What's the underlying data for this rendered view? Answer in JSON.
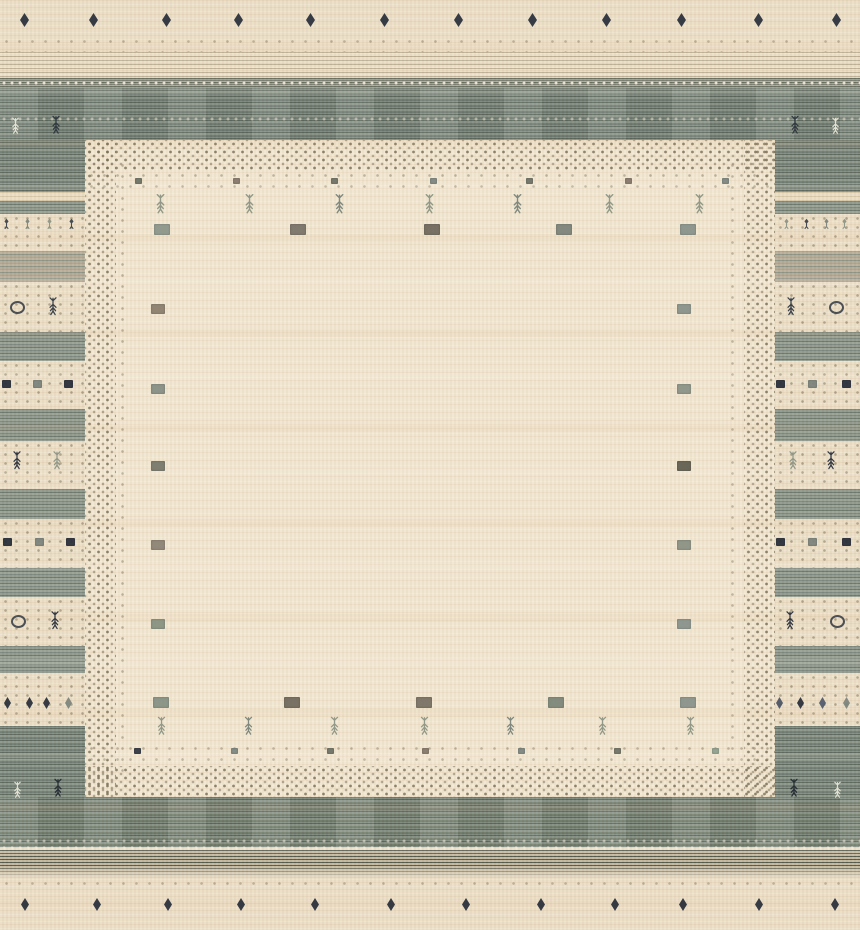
{
  "subject": "hand-knotted gabbeh-style wool rug, cream field with gray-green frame and tribal motifs",
  "palette": {
    "cream": "#ebdfc8",
    "cream-field": "#f1e6d0",
    "gray-band": "#79837a",
    "gray-band-dark": "#5f6a5f",
    "gray-band-light": "#8d978b",
    "tan-band": "#a8a494",
    "dot": "#7d7158",
    "navy": "#262c38",
    "slate": "#7b837c",
    "sage": "#8b9383",
    "olive": "#6f7265",
    "brown": "#8a7c6a",
    "white-motif": "#edeadb"
  },
  "frame": {
    "top_gray_band": {
      "y": 88,
      "h": 52
    },
    "bottom_gray_band": {
      "y": 797,
      "h": 50
    },
    "side_width": 85
  },
  "border_bands": [
    {
      "y": 140,
      "h": 52,
      "k": "grayext"
    },
    {
      "y": 192,
      "h": 9,
      "k": "tan"
    },
    {
      "y": 201,
      "h": 13,
      "k": "gray"
    },
    {
      "y": 214,
      "h": 37,
      "k": "dots"
    },
    {
      "y": 251,
      "h": 31,
      "k": "tanband"
    },
    {
      "y": 282,
      "h": 50,
      "k": "dots"
    },
    {
      "y": 332,
      "h": 29,
      "k": "gray"
    },
    {
      "y": 361,
      "h": 48,
      "k": "dots"
    },
    {
      "y": 409,
      "h": 32,
      "k": "gray"
    },
    {
      "y": 441,
      "h": 48,
      "k": "dots"
    },
    {
      "y": 489,
      "h": 30,
      "k": "gray"
    },
    {
      "y": 519,
      "h": 49,
      "k": "dots"
    },
    {
      "y": 568,
      "h": 29,
      "k": "gray"
    },
    {
      "y": 597,
      "h": 49,
      "k": "dots"
    },
    {
      "y": 646,
      "h": 27,
      "k": "gray"
    },
    {
      "y": 673,
      "h": 53,
      "k": "dots"
    },
    {
      "y": 726,
      "h": 71,
      "k": "grayext"
    }
  ],
  "motifs": [
    {
      "t": "d",
      "x": 20,
      "y": 13,
      "w": 9,
      "h": 14,
      "c": "#262c38"
    },
    {
      "t": "d",
      "x": 89,
      "y": 13,
      "w": 9,
      "h": 14,
      "c": "#262c38"
    },
    {
      "t": "d",
      "x": 162,
      "y": 13,
      "w": 9,
      "h": 14,
      "c": "#262c38"
    },
    {
      "t": "d",
      "x": 234,
      "y": 13,
      "w": 9,
      "h": 14,
      "c": "#262c38"
    },
    {
      "t": "d",
      "x": 306,
      "y": 13,
      "w": 9,
      "h": 14,
      "c": "#262c38"
    },
    {
      "t": "d",
      "x": 380,
      "y": 13,
      "w": 9,
      "h": 14,
      "c": "#262c38"
    },
    {
      "t": "d",
      "x": 454,
      "y": 13,
      "w": 9,
      "h": 14,
      "c": "#262c38"
    },
    {
      "t": "d",
      "x": 528,
      "y": 13,
      "w": 9,
      "h": 14,
      "c": "#262c38"
    },
    {
      "t": "d",
      "x": 602,
      "y": 13,
      "w": 9,
      "h": 14,
      "c": "#262c38"
    },
    {
      "t": "d",
      "x": 677,
      "y": 13,
      "w": 9,
      "h": 14,
      "c": "#262c38"
    },
    {
      "t": "d",
      "x": 754,
      "y": 13,
      "w": 9,
      "h": 14,
      "c": "#262c38"
    },
    {
      "t": "d",
      "x": 832,
      "y": 13,
      "w": 9,
      "h": 14,
      "c": "#262c38"
    },
    {
      "t": "t",
      "x": 10,
      "y": 117,
      "w": 11,
      "h": 17,
      "c": "#edeadb"
    },
    {
      "t": "t",
      "x": 50,
      "y": 115,
      "w": 12,
      "h": 19,
      "c": "#2c333d"
    },
    {
      "t": "t",
      "x": 789,
      "y": 115,
      "w": 12,
      "h": 19,
      "c": "#2c333d"
    },
    {
      "t": "t",
      "x": 830,
      "y": 117,
      "w": 11,
      "h": 17,
      "c": "#edeadb"
    },
    {
      "t": "s",
      "x": 135,
      "y": 178,
      "w": 7,
      "h": 6,
      "c": "#6d7164"
    },
    {
      "t": "s",
      "x": 233,
      "y": 178,
      "w": 7,
      "h": 6,
      "c": "#84776a"
    },
    {
      "t": "s",
      "x": 331,
      "y": 178,
      "w": 7,
      "h": 6,
      "c": "#6d7164"
    },
    {
      "t": "s",
      "x": 430,
      "y": 178,
      "w": 7,
      "h": 6,
      "c": "#7c8680"
    },
    {
      "t": "s",
      "x": 526,
      "y": 178,
      "w": 7,
      "h": 6,
      "c": "#6d7164"
    },
    {
      "t": "s",
      "x": 625,
      "y": 178,
      "w": 7,
      "h": 6,
      "c": "#84776a"
    },
    {
      "t": "s",
      "x": 722,
      "y": 178,
      "w": 7,
      "h": 6,
      "c": "#7c8680"
    },
    {
      "t": "t",
      "x": 154,
      "y": 193,
      "w": 13,
      "h": 21,
      "c": "#8b9383"
    },
    {
      "t": "t",
      "x": 243,
      "y": 193,
      "w": 13,
      "h": 21,
      "c": "#8b9383"
    },
    {
      "t": "t",
      "x": 333,
      "y": 193,
      "w": 13,
      "h": 21,
      "c": "#77827a"
    },
    {
      "t": "t",
      "x": 423,
      "y": 193,
      "w": 13,
      "h": 21,
      "c": "#8b9383"
    },
    {
      "t": "t",
      "x": 511,
      "y": 193,
      "w": 13,
      "h": 21,
      "c": "#77827a"
    },
    {
      "t": "t",
      "x": 603,
      "y": 193,
      "w": 13,
      "h": 21,
      "c": "#8b9383"
    },
    {
      "t": "t",
      "x": 693,
      "y": 193,
      "w": 13,
      "h": 21,
      "c": "#8b9383"
    },
    {
      "t": "s",
      "x": 154,
      "y": 224,
      "w": 16,
      "h": 11,
      "c": "#8b9489"
    },
    {
      "t": "s",
      "x": 290,
      "y": 224,
      "w": 16,
      "h": 11,
      "c": "#787166"
    },
    {
      "t": "s",
      "x": 424,
      "y": 224,
      "w": 16,
      "h": 11,
      "c": "#6e675b"
    },
    {
      "t": "s",
      "x": 556,
      "y": 224,
      "w": 16,
      "h": 11,
      "c": "#7b8279"
    },
    {
      "t": "s",
      "x": 680,
      "y": 224,
      "w": 16,
      "h": 11,
      "c": "#87918a"
    },
    {
      "t": "s",
      "x": 151,
      "y": 304,
      "w": 14,
      "h": 10,
      "c": "#8a7d6c"
    },
    {
      "t": "s",
      "x": 151,
      "y": 384,
      "w": 14,
      "h": 10,
      "c": "#858d83"
    },
    {
      "t": "s",
      "x": 151,
      "y": 461,
      "w": 14,
      "h": 10,
      "c": "#75766a"
    },
    {
      "t": "s",
      "x": 151,
      "y": 540,
      "w": 14,
      "h": 10,
      "c": "#8b8274"
    },
    {
      "t": "s",
      "x": 151,
      "y": 619,
      "w": 14,
      "h": 10,
      "c": "#86907f"
    },
    {
      "t": "s",
      "x": 677,
      "y": 304,
      "w": 14,
      "h": 10,
      "c": "#87918a"
    },
    {
      "t": "s",
      "x": 677,
      "y": 384,
      "w": 14,
      "h": 10,
      "c": "#8a9286"
    },
    {
      "t": "s",
      "x": 677,
      "y": 461,
      "w": 14,
      "h": 10,
      "c": "#5f5c4e"
    },
    {
      "t": "s",
      "x": 677,
      "y": 540,
      "w": 14,
      "h": 10,
      "c": "#899083"
    },
    {
      "t": "s",
      "x": 677,
      "y": 619,
      "w": 14,
      "h": 10,
      "c": "#87918a"
    },
    {
      "t": "s",
      "x": 153,
      "y": 697,
      "w": 16,
      "h": 11,
      "c": "#849083"
    },
    {
      "t": "s",
      "x": 284,
      "y": 697,
      "w": 16,
      "h": 11,
      "c": "#6e675b"
    },
    {
      "t": "s",
      "x": 416,
      "y": 697,
      "w": 16,
      "h": 11,
      "c": "#776f62"
    },
    {
      "t": "s",
      "x": 548,
      "y": 697,
      "w": 16,
      "h": 11,
      "c": "#7b8478"
    },
    {
      "t": "s",
      "x": 680,
      "y": 697,
      "w": 16,
      "h": 11,
      "c": "#87918a"
    },
    {
      "t": "t",
      "x": 155,
      "y": 716,
      "w": 13,
      "h": 19,
      "c": "#8b9383"
    },
    {
      "t": "t",
      "x": 242,
      "y": 716,
      "w": 13,
      "h": 19,
      "c": "#77827a"
    },
    {
      "t": "t",
      "x": 328,
      "y": 716,
      "w": 13,
      "h": 19,
      "c": "#8b9383"
    },
    {
      "t": "t",
      "x": 418,
      "y": 716,
      "w": 13,
      "h": 19,
      "c": "#8b9383"
    },
    {
      "t": "t",
      "x": 504,
      "y": 716,
      "w": 13,
      "h": 19,
      "c": "#77827a"
    },
    {
      "t": "t",
      "x": 596,
      "y": 716,
      "w": 13,
      "h": 19,
      "c": "#8b9383"
    },
    {
      "t": "t",
      "x": 684,
      "y": 716,
      "w": 13,
      "h": 19,
      "c": "#8b9383"
    },
    {
      "t": "s",
      "x": 134,
      "y": 748,
      "w": 7,
      "h": 6,
      "c": "#2e3440"
    },
    {
      "t": "s",
      "x": 231,
      "y": 748,
      "w": 7,
      "h": 6,
      "c": "#7c8680"
    },
    {
      "t": "s",
      "x": 327,
      "y": 748,
      "w": 7,
      "h": 6,
      "c": "#6d7164"
    },
    {
      "t": "s",
      "x": 422,
      "y": 748,
      "w": 7,
      "h": 6,
      "c": "#84776a"
    },
    {
      "t": "s",
      "x": 518,
      "y": 748,
      "w": 7,
      "h": 6,
      "c": "#7c8680"
    },
    {
      "t": "s",
      "x": 614,
      "y": 748,
      "w": 7,
      "h": 6,
      "c": "#6d7164"
    },
    {
      "t": "s",
      "x": 712,
      "y": 748,
      "w": 7,
      "h": 6,
      "c": "#8fa08f"
    },
    {
      "t": "y",
      "x": 3,
      "y": 218,
      "w": 7,
      "h": 12,
      "c": "#3a4048"
    },
    {
      "t": "y",
      "x": 24,
      "y": 218,
      "w": 7,
      "h": 12,
      "c": "#7b837c"
    },
    {
      "t": "y",
      "x": 46,
      "y": 218,
      "w": 7,
      "h": 12,
      "c": "#8b9383"
    },
    {
      "t": "y",
      "x": 68,
      "y": 218,
      "w": 7,
      "h": 12,
      "c": "#3a4048"
    },
    {
      "t": "c",
      "x": 10,
      "y": 301,
      "w": 11,
      "h": 9,
      "c": "#3f444b"
    },
    {
      "t": "t",
      "x": 47,
      "y": 296,
      "w": 12,
      "h": 20,
      "c": "#2e3640"
    },
    {
      "t": "s",
      "x": 2,
      "y": 380,
      "w": 9,
      "h": 8,
      "c": "#262c38"
    },
    {
      "t": "s",
      "x": 33,
      "y": 380,
      "w": 9,
      "h": 8,
      "c": "#7b837c"
    },
    {
      "t": "s",
      "x": 64,
      "y": 380,
      "w": 9,
      "h": 8,
      "c": "#262c38"
    },
    {
      "t": "t",
      "x": 11,
      "y": 450,
      "w": 12,
      "h": 20,
      "c": "#262c38"
    },
    {
      "t": "t",
      "x": 51,
      "y": 450,
      "w": 12,
      "h": 20,
      "c": "#8b9383"
    },
    {
      "t": "s",
      "x": 3,
      "y": 538,
      "w": 9,
      "h": 8,
      "c": "#262c38"
    },
    {
      "t": "s",
      "x": 35,
      "y": 538,
      "w": 9,
      "h": 8,
      "c": "#7b837c"
    },
    {
      "t": "s",
      "x": 66,
      "y": 538,
      "w": 9,
      "h": 8,
      "c": "#262c38"
    },
    {
      "t": "c",
      "x": 11,
      "y": 615,
      "w": 11,
      "h": 9,
      "c": "#3f444b"
    },
    {
      "t": "t",
      "x": 49,
      "y": 610,
      "w": 12,
      "h": 20,
      "c": "#262c38"
    },
    {
      "t": "d",
      "x": 4,
      "y": 697,
      "w": 7,
      "h": 12,
      "c": "#262c38"
    },
    {
      "t": "d",
      "x": 26,
      "y": 697,
      "w": 7,
      "h": 12,
      "c": "#262c38"
    },
    {
      "t": "d",
      "x": 43,
      "y": 697,
      "w": 7,
      "h": 12,
      "c": "#262c38"
    },
    {
      "t": "d",
      "x": 65,
      "y": 697,
      "w": 7,
      "h": 12,
      "c": "#7b837c"
    },
    {
      "t": "t",
      "x": 12,
      "y": 781,
      "w": 11,
      "h": 17,
      "c": "#e8e8da"
    },
    {
      "t": "t",
      "x": 52,
      "y": 778,
      "w": 12,
      "h": 19,
      "c": "#222831"
    },
    {
      "t": "y",
      "x": 783,
      "y": 218,
      "w": 7,
      "h": 12,
      "c": "#8b9383"
    },
    {
      "t": "y",
      "x": 803,
      "y": 218,
      "w": 7,
      "h": 12,
      "c": "#3a4048"
    },
    {
      "t": "y",
      "x": 823,
      "y": 218,
      "w": 7,
      "h": 12,
      "c": "#7b837c"
    },
    {
      "t": "y",
      "x": 841,
      "y": 218,
      "w": 7,
      "h": 12,
      "c": "#8b9383"
    },
    {
      "t": "t",
      "x": 785,
      "y": 296,
      "w": 12,
      "h": 20,
      "c": "#2e3640"
    },
    {
      "t": "c",
      "x": 829,
      "y": 301,
      "w": 11,
      "h": 9,
      "c": "#3f444b"
    },
    {
      "t": "s",
      "x": 776,
      "y": 380,
      "w": 9,
      "h": 8,
      "c": "#262c38"
    },
    {
      "t": "s",
      "x": 808,
      "y": 380,
      "w": 9,
      "h": 8,
      "c": "#7b837c"
    },
    {
      "t": "s",
      "x": 842,
      "y": 380,
      "w": 9,
      "h": 8,
      "c": "#262c38"
    },
    {
      "t": "t",
      "x": 787,
      "y": 450,
      "w": 12,
      "h": 20,
      "c": "#8b9383"
    },
    {
      "t": "t",
      "x": 825,
      "y": 450,
      "w": 12,
      "h": 20,
      "c": "#262c38"
    },
    {
      "t": "s",
      "x": 776,
      "y": 538,
      "w": 9,
      "h": 8,
      "c": "#262c38"
    },
    {
      "t": "s",
      "x": 808,
      "y": 538,
      "w": 9,
      "h": 8,
      "c": "#7b837c"
    },
    {
      "t": "s",
      "x": 842,
      "y": 538,
      "w": 9,
      "h": 8,
      "c": "#262c38"
    },
    {
      "t": "t",
      "x": 784,
      "y": 610,
      "w": 12,
      "h": 20,
      "c": "#262c38"
    },
    {
      "t": "c",
      "x": 830,
      "y": 615,
      "w": 11,
      "h": 9,
      "c": "#3f444b"
    },
    {
      "t": "d",
      "x": 776,
      "y": 697,
      "w": 7,
      "h": 12,
      "c": "#4a5363"
    },
    {
      "t": "d",
      "x": 797,
      "y": 697,
      "w": 7,
      "h": 12,
      "c": "#262c38"
    },
    {
      "t": "d",
      "x": 819,
      "y": 697,
      "w": 7,
      "h": 12,
      "c": "#4f586a"
    },
    {
      "t": "d",
      "x": 843,
      "y": 697,
      "w": 7,
      "h": 12,
      "c": "#7b837c"
    },
    {
      "t": "t",
      "x": 788,
      "y": 778,
      "w": 12,
      "h": 19,
      "c": "#222831"
    },
    {
      "t": "t",
      "x": 832,
      "y": 781,
      "w": 11,
      "h": 17,
      "c": "#e8e8da"
    },
    {
      "t": "d",
      "x": 21,
      "y": 898,
      "w": 8,
      "h": 13,
      "c": "#262c38"
    },
    {
      "t": "d",
      "x": 93,
      "y": 898,
      "w": 8,
      "h": 13,
      "c": "#262c38"
    },
    {
      "t": "d",
      "x": 164,
      "y": 898,
      "w": 8,
      "h": 13,
      "c": "#262c38"
    },
    {
      "t": "d",
      "x": 237,
      "y": 898,
      "w": 8,
      "h": 13,
      "c": "#262c38"
    },
    {
      "t": "d",
      "x": 311,
      "y": 898,
      "w": 8,
      "h": 13,
      "c": "#262c38"
    },
    {
      "t": "d",
      "x": 387,
      "y": 898,
      "w": 8,
      "h": 13,
      "c": "#262c38"
    },
    {
      "t": "d",
      "x": 462,
      "y": 898,
      "w": 8,
      "h": 13,
      "c": "#262c38"
    },
    {
      "t": "d",
      "x": 537,
      "y": 898,
      "w": 8,
      "h": 13,
      "c": "#262c38"
    },
    {
      "t": "d",
      "x": 611,
      "y": 898,
      "w": 8,
      "h": 13,
      "c": "#262c38"
    },
    {
      "t": "d",
      "x": 679,
      "y": 898,
      "w": 8,
      "h": 13,
      "c": "#262c38"
    },
    {
      "t": "d",
      "x": 755,
      "y": 898,
      "w": 8,
      "h": 13,
      "c": "#262c38"
    },
    {
      "t": "d",
      "x": 831,
      "y": 898,
      "w": 8,
      "h": 13,
      "c": "#262c38"
    }
  ]
}
